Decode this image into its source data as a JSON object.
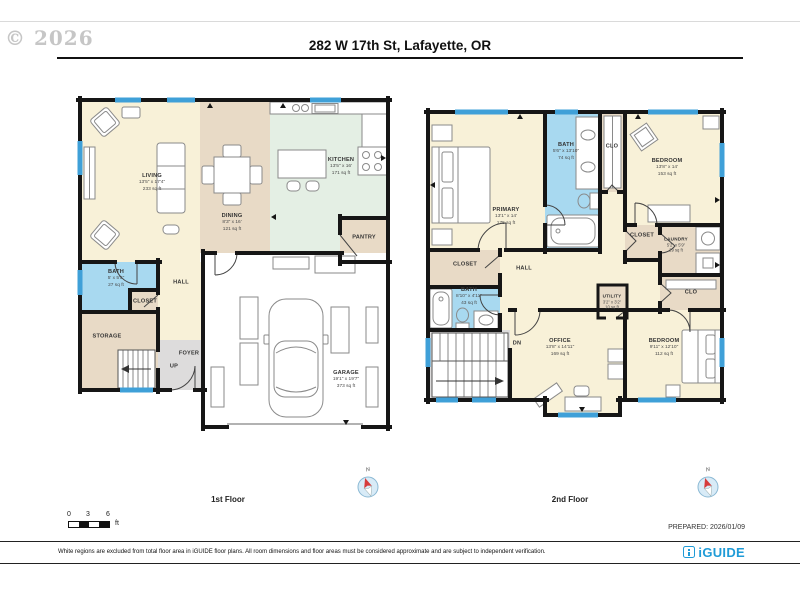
{
  "watermark": "© 2026",
  "header": {
    "title": "282 W 17th St, Lafayette, OR"
  },
  "colors": {
    "wall": "#161616",
    "window_blue": "#3fa0d8",
    "room_cream": "#f8f1d8",
    "room_tan": "#e8dac6",
    "room_mint": "#e4efe4",
    "room_bath_blue": "#a8d9f0",
    "room_gray": "#dddcdc",
    "brand_teal": "#1f9bd7",
    "compass_red": "#d63b3b"
  },
  "floor1": {
    "label": "1st Floor",
    "rooms": {
      "living": {
        "name": "LIVING",
        "dims": "13'5\" x 17'4\"",
        "area": "233 sq ft"
      },
      "dining": {
        "name": "DINING",
        "dims": "8'3\" x 16'",
        "area": "121 sq ft"
      },
      "kitchen": {
        "name": "KITCHEN",
        "dims": "13'5\" x 16'",
        "area": "171 sq ft"
      },
      "pantry": {
        "name": "PANTRY"
      },
      "bath": {
        "name": "BATH",
        "dims": "5' x 5'5\"",
        "area": "27 sq ft"
      },
      "closet": {
        "name": "CLOSET"
      },
      "storage": {
        "name": "STORAGE"
      },
      "hall": {
        "name": "HALL"
      },
      "foyer": {
        "name": "FOYER"
      },
      "up": {
        "name": "UP"
      },
      "garage": {
        "name": "GARAGE",
        "dims": "19'1\" x 19'7\"",
        "area": "373 sq ft"
      }
    }
  },
  "floor2": {
    "label": "2nd Floor",
    "rooms": {
      "primary": {
        "name": "PRIMARY",
        "dims": "13'1\" x 14'",
        "area": "175 sq ft"
      },
      "bath_primary": {
        "name": "BATH",
        "dims": "5'6\" x 13'10\"",
        "area": "74 sq ft"
      },
      "clo_top": {
        "name": "CLO"
      },
      "bedroom_top": {
        "name": "BEDROOM",
        "dims": "13'8\" x 14'",
        "area": "153 sq ft"
      },
      "closet_right": {
        "name": "CLOSET"
      },
      "laundry": {
        "name": "LAUNDRY",
        "dims": "5'2\" x 5'9\"",
        "area": "29 sq ft"
      },
      "clo_right": {
        "name": "CLO"
      },
      "closet_left": {
        "name": "CLOSET"
      },
      "hall": {
        "name": "HALL"
      },
      "bath_hall": {
        "name": "BATH",
        "dims": "8'10\" x 4'11\"",
        "area": "43 sq ft"
      },
      "utility": {
        "name": "UTILITY",
        "dims": "3'2\" x 3'2\"",
        "area": "10 sq ft"
      },
      "office": {
        "name": "OFFICE",
        "dims": "13'8\" x 14'11\"",
        "area": "169 sq ft"
      },
      "bedroom_bottom": {
        "name": "BEDROOM",
        "dims": "9'11\" x 12'10\"",
        "area": "112 sq ft"
      },
      "dn": {
        "name": "DN"
      }
    }
  },
  "compass": {
    "north": "N"
  },
  "scale": {
    "t0": "0",
    "t1": "3",
    "t2": "6",
    "unit": "ft"
  },
  "footer": {
    "prepared": "PREPARED: 2026/01/09",
    "disclaimer": "White regions are excluded from total floor area in iGUIDE floor plans. All room dimensions and floor areas must be considered approximate and are subject to independent verification.",
    "brand": "iGUIDE"
  }
}
